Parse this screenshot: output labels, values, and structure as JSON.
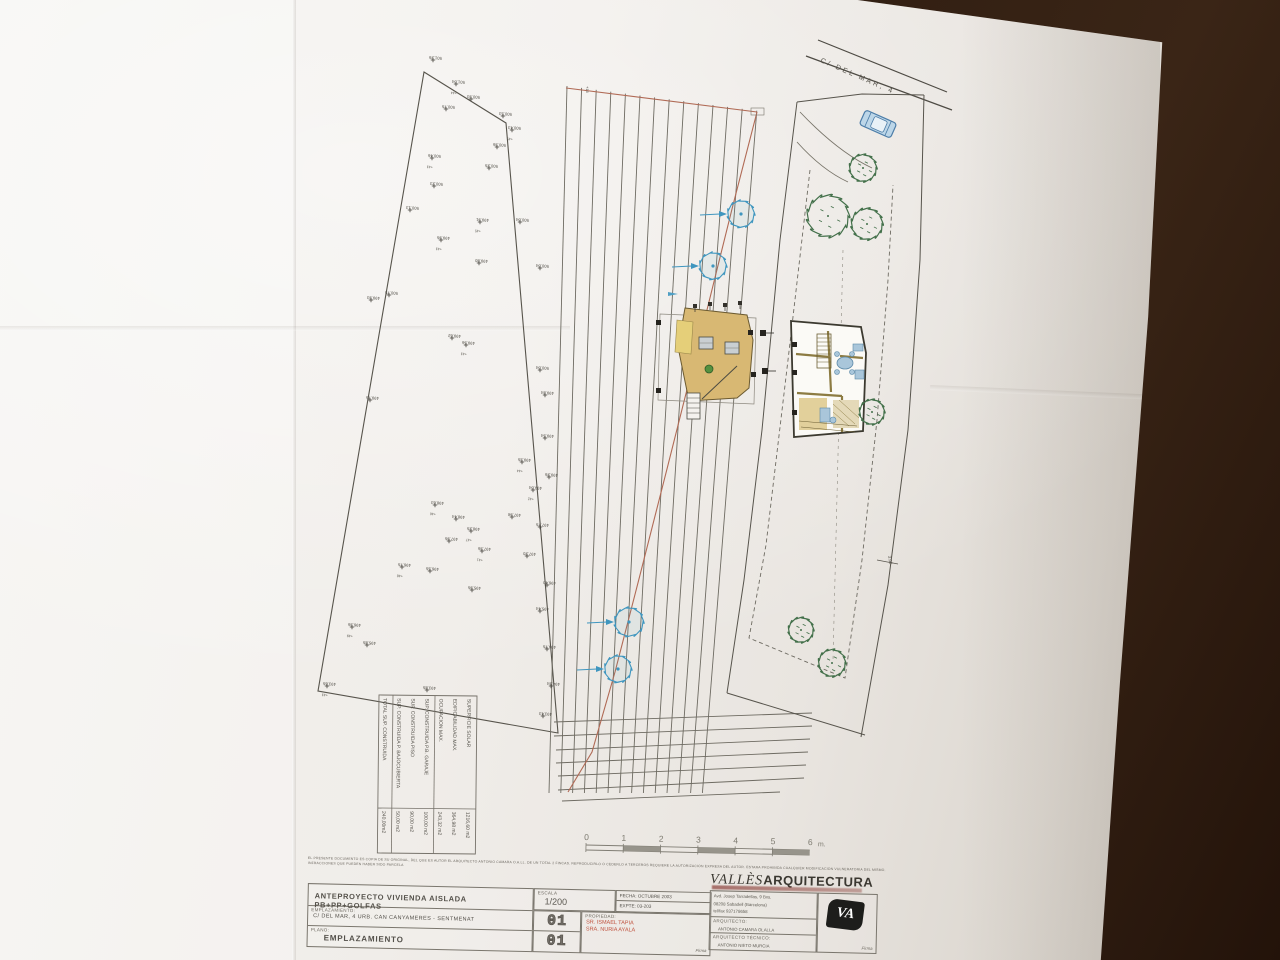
{
  "titleblock": {
    "project": "ANTEPROYECTO   VIVIENDA AISLADA PB+PP+GOLFAS",
    "escala_label": "ESCALA",
    "escala": "1/200",
    "fecha_label": "FECHA:  OCTUBRE 2003",
    "expte_label": "EXPTE:  03-203",
    "emplazamiento_label": "EMPLAZAMIENTO:",
    "emplazamiento": "C/ DEL MAR, 4   URB. CAN CANYAMERES  -  SENTMENAT",
    "plano_label": "PLANO:",
    "plano": "EMPLAZAMIENTO",
    "sheet_top": "01",
    "sheet_bottom": "01",
    "propiedad_label": "PROPIEDAD:",
    "propiedad_1": "SR. ISMAEL TAPIA",
    "propiedad_2": "SRA. NURIA AYALA",
    "firma_label": "Firma",
    "firma_label_2": "Firma",
    "office_serif": "VALLÈS",
    "office_bold": "ARQUITECTURA",
    "office_address_1": "Avd. Josep Tarradellas, 9 Bxs.",
    "office_address_2": "08208 Sabadell (Barcelona)",
    "office_address_3": "tel/fax  937178658",
    "arquitecto_label": "ARQUITECTO:",
    "arquitecto": "ANTONIO CAMARA OLALLA",
    "arq_tecnico_label": "ARQUITECTO TÉCNICO:",
    "arq_tecnico": "ANTONIO NIETO MURCIA",
    "logo_text": "VA"
  },
  "disclaimer": {
    "line1": "EL PRESENTE DOCUMENTO ES COPIA DE SU ORIGINAL, DEL QUE ES AUTOR EL ARQUITECTO ANTONIO CAMARA O.A.LL. DE UN TOTAL 2 FINCAS. REPRODUCIRLO O CEDERLO A TERCEROS REQUIERE LA AUTORIZACION EXPRESA DEL AUTOR. ESTARA PROHIBIDA CUALQUIER MODIFICACION VULNERATORIA DEL MISMO.",
    "line2": "INFRACCIONES QUE PUEDEN HABER SIDO PARCELA"
  },
  "street_label": "C/  DEL  MAR,  4",
  "dim_label": "3.00",
  "tick_label": "+16",
  "areas_table": {
    "rows": [
      {
        "label": "SUPERFICIE SOLAR",
        "value": "1216,60 m2"
      },
      {
        "label": "EDIFICABILIDAD MAX.",
        "value": "364,98 m2"
      },
      {
        "label": "OCUPACION MAX.",
        "value": "243,32 m2"
      },
      {
        "label": "SUP. CONSTRUIDA P.B. GARAJE",
        "value": "100,00 m2"
      },
      {
        "label": "SUP. CONSTRUIDA PISO",
        "value": "90,00 m2"
      },
      {
        "label": "SUP. CONSTRUIDA P. BAJOCUBIERTA",
        "value": "50,00 m2"
      },
      {
        "label": "TOTAL SUP. CONSTRUIDA",
        "value": "240,00m2"
      }
    ]
  },
  "scalebar": {
    "labels": [
      "0",
      "1",
      "2",
      "3",
      "4",
      "5",
      "6"
    ],
    "unit": "m.",
    "x0": 586,
    "y": 845,
    "seg": 37.3
  },
  "colors": {
    "ink": "#57544c",
    "ink_light": "#787469",
    "red_line": "#b06a55",
    "prop_red": "#c0523e",
    "blue_tree": "#3f96bf",
    "green_tree": "#43704a",
    "roof_tan": "#d8b873",
    "car_fill": "#bcd6e8"
  },
  "survey_points": [
    {
      "x": 433,
      "y": 60,
      "v": "501.26"
    },
    {
      "x": 456,
      "y": 84,
      "v": "501.04",
      "n": "44"
    },
    {
      "x": 471,
      "y": 99,
      "v": "500.93"
    },
    {
      "x": 503,
      "y": 116,
      "v": "500.53"
    },
    {
      "x": 512,
      "y": 130,
      "v": "500.43",
      "n": "45"
    },
    {
      "x": 446,
      "y": 109,
      "v": "500.75"
    },
    {
      "x": 497,
      "y": 147,
      "v": "500.36"
    },
    {
      "x": 432,
      "y": 158,
      "v": "500.46",
      "n": "43"
    },
    {
      "x": 489,
      "y": 168,
      "v": "500.25"
    },
    {
      "x": 434,
      "y": 186,
      "v": "500.23"
    },
    {
      "x": 410,
      "y": 210,
      "v": "500.13"
    },
    {
      "x": 480,
      "y": 222,
      "v": "499.91",
      "n": "45"
    },
    {
      "x": 520,
      "y": 222,
      "v": "500.04"
    },
    {
      "x": 441,
      "y": 240,
      "v": "499.95",
      "n": "43"
    },
    {
      "x": 479,
      "y": 263,
      "v": "499.80"
    },
    {
      "x": 540,
      "y": 268,
      "v": "500.04"
    },
    {
      "x": 389,
      "y": 295,
      "v": "500.75"
    },
    {
      "x": 371,
      "y": 300,
      "v": "499.93"
    },
    {
      "x": 466,
      "y": 345,
      "v": "499.56",
      "n": "43"
    },
    {
      "x": 452,
      "y": 338,
      "v": "499.62"
    },
    {
      "x": 540,
      "y": 370,
      "v": "500.04"
    },
    {
      "x": 545,
      "y": 395,
      "v": "499.84"
    },
    {
      "x": 370,
      "y": 400,
      "v": "499.75"
    },
    {
      "x": 545,
      "y": 438,
      "v": "499.54"
    },
    {
      "x": 522,
      "y": 462,
      "v": "499.35",
      "n": "44"
    },
    {
      "x": 549,
      "y": 477,
      "v": "499.26"
    },
    {
      "x": 533,
      "y": 490,
      "v": "499.04",
      "n": "42"
    },
    {
      "x": 435,
      "y": 505,
      "v": "498.63",
      "n": "46"
    },
    {
      "x": 456,
      "y": 519,
      "v": "498.44"
    },
    {
      "x": 471,
      "y": 531,
      "v": "498.25",
      "n": "47"
    },
    {
      "x": 449,
      "y": 541,
      "v": "497.95"
    },
    {
      "x": 512,
      "y": 517,
      "v": "497.98"
    },
    {
      "x": 540,
      "y": 527,
      "v": "497.75"
    },
    {
      "x": 482,
      "y": 551,
      "v": "497.36",
      "n": "41"
    },
    {
      "x": 527,
      "y": 556,
      "v": "497.20"
    },
    {
      "x": 402,
      "y": 567,
      "v": "496.75",
      "n": "48"
    },
    {
      "x": 430,
      "y": 571,
      "v": "496.55"
    },
    {
      "x": 547,
      "y": 585,
      "v": "496.40"
    },
    {
      "x": 472,
      "y": 590,
      "v": "495.95"
    },
    {
      "x": 540,
      "y": 611,
      "v": "495.44"
    },
    {
      "x": 352,
      "y": 627,
      "v": "496.36",
      "n": "49"
    },
    {
      "x": 367,
      "y": 645,
      "v": "495.85"
    },
    {
      "x": 547,
      "y": 649,
      "v": "494.75"
    },
    {
      "x": 551,
      "y": 686,
      "v": "494.34"
    },
    {
      "x": 327,
      "y": 686,
      "v": "493.65",
      "n": "43"
    },
    {
      "x": 427,
      "y": 690,
      "v": "493.85"
    },
    {
      "x": 543,
      "y": 716,
      "v": "493.43"
    }
  ],
  "drawing": {
    "left_parcel": [
      [
        424,
        72
      ],
      [
        506,
        123
      ],
      [
        558,
        733
      ],
      [
        318,
        691
      ]
    ],
    "contour": {
      "count": 14,
      "x0_top": 567,
      "dx_top": 14.6,
      "y0_top": 86,
      "dy_top": 1.9,
      "x0_bot": 549,
      "dx_bot": 11.8,
      "y_bot": 793
    },
    "bottom_lines": [
      [
        554,
        722,
        812,
        713
      ],
      [
        554,
        736,
        812,
        726
      ],
      [
        556,
        750,
        810,
        739
      ],
      [
        556,
        763,
        808,
        752
      ],
      [
        558,
        776,
        806,
        765
      ],
      [
        558,
        790,
        804,
        778
      ],
      [
        562,
        801,
        780,
        792
      ]
    ],
    "red_top": [
      566,
      88,
      757,
      112
    ],
    "red_curve": [
      [
        757,
        112
      ],
      [
        733,
        205
      ],
      [
        702,
        330
      ],
      [
        668,
        465
      ],
      [
        640,
        575
      ],
      [
        615,
        672
      ],
      [
        592,
        752
      ],
      [
        568,
        792
      ]
    ],
    "road": [
      [
        818,
        40,
        947,
        92
      ],
      [
        806,
        56,
        952,
        110
      ]
    ],
    "rp_left": [
      [
        797,
        102
      ],
      [
        780,
        240
      ],
      [
        762,
        430
      ],
      [
        744,
        580
      ],
      [
        727,
        693
      ]
    ],
    "rp_right": [
      [
        924,
        95
      ],
      [
        920,
        260
      ],
      [
        908,
        430
      ],
      [
        888,
        585
      ],
      [
        861,
        737
      ]
    ],
    "rp_bottom": [
      [
        727,
        693
      ],
      [
        865,
        735
      ]
    ],
    "rp_top": [
      [
        797,
        102
      ],
      [
        862,
        94
      ],
      [
        924,
        95
      ]
    ],
    "dashed_setback": [
      [
        810,
        170
      ],
      [
        788,
        360
      ],
      [
        766,
        545
      ],
      [
        749,
        638
      ],
      [
        845,
        678
      ],
      [
        862,
        560
      ],
      [
        877,
        420
      ],
      [
        888,
        280
      ],
      [
        893,
        185
      ]
    ],
    "center_dashed": [
      843,
      250,
      833,
      660
    ],
    "driveway": [
      "M800,112 Q838,152 872,168",
      "M797,142 Q822,170 848,182"
    ],
    "dim300": {
      "x": 884,
      "y": 560
    },
    "blue_trees": [
      [
        741,
        214,
        13
      ],
      [
        713,
        266,
        13
      ],
      [
        629,
        622,
        14
      ],
      [
        618,
        669,
        13
      ]
    ],
    "green_trees": [
      [
        863,
        168,
        13
      ],
      [
        828,
        216,
        20
      ],
      [
        867,
        224,
        15
      ],
      [
        872,
        412,
        12
      ],
      [
        801,
        630,
        12
      ],
      [
        832,
        663,
        13
      ]
    ],
    "car": {
      "x": 878,
      "y": 124,
      "angle": 24
    },
    "label_box": [
      751,
      108,
      13,
      7
    ],
    "street_label_pos": {
      "x": 820,
      "y": 62,
      "angle": 23.5
    },
    "tick_pos": {
      "x": 586,
      "y": 86
    }
  }
}
